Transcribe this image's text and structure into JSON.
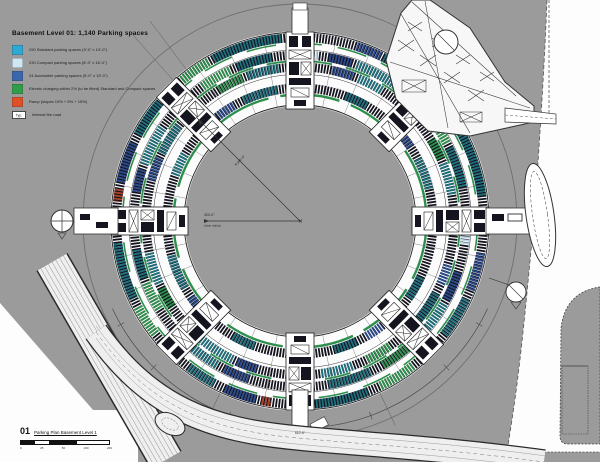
{
  "legend": {
    "title": "Basement Level 01: 1,140 Parking spaces",
    "items": [
      {
        "color": "#2ea8d5",
        "label": "290 Standard parking spaces (9'-0\" x 19'-0\")"
      },
      {
        "color": "#cfe6f3",
        "label": "230 Compact parking spaces (8'-0\" x 16'-0\")"
      },
      {
        "color": "#3a66ae",
        "label": "24 Accessible parking spaces (9'-0\" x 19'-0\")"
      },
      {
        "color": "#2f9e4a",
        "label": "Electric charging within 2% (to be fitted) Standard and Compact spaces"
      },
      {
        "color": "#e04f26",
        "label": "Ramp (slopes 15% + 5% + 15%)"
      },
      {
        "color": "#ffffff",
        "swatch_text": "Typ.",
        "label": "Internal fire road"
      }
    ]
  },
  "dimensions": {
    "radius_label_line1": "324'-0\"",
    "radius_label_line2": "(clear radius)",
    "diagonal_label": "R 380'-0\"",
    "arc_label": "610'-0\""
  },
  "title_block": {
    "number": "01",
    "title": "Parking Plan Basement Level 1",
    "scale_ticks": [
      "0",
      "25",
      "50",
      "100",
      "200"
    ]
  },
  "colors": {
    "site_gray": "#9b9b9b",
    "stall_dark": "#14141f",
    "stall_teal": "#1e6f7c",
    "stall_green": "#2e8f4c",
    "stall_navy": "#2b4a8c",
    "stall_red": "#a8432c"
  }
}
